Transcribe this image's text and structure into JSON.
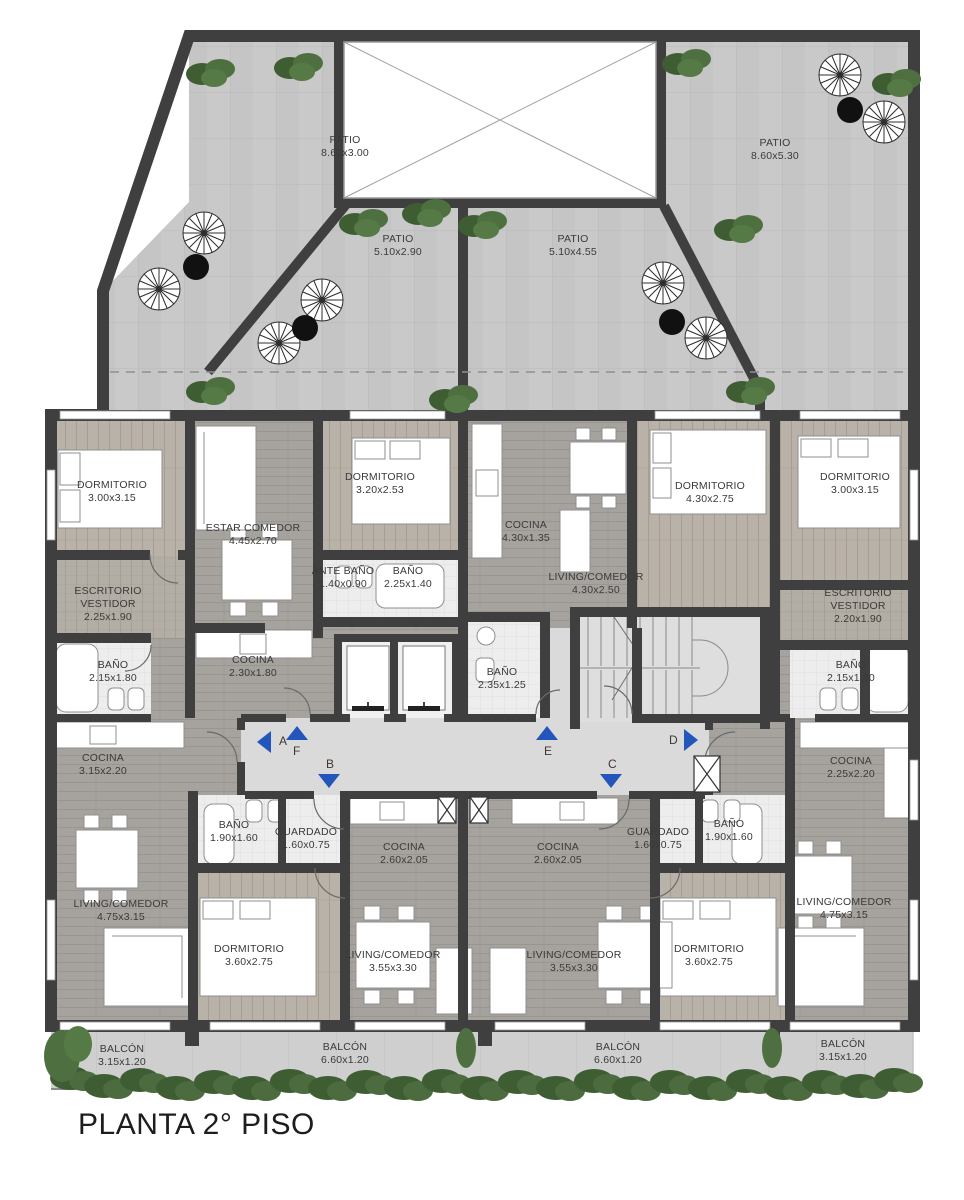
{
  "title": "PLANTA 2° PISO",
  "patios": {
    "nw": {
      "name": "PATIO",
      "dims": "8.60x3.00"
    },
    "cw": {
      "name": "PATIO",
      "dims": "5.10x2.90"
    },
    "ce": {
      "name": "PATIO",
      "dims": "5.10x4.55"
    },
    "ne": {
      "name": "PATIO",
      "dims": "8.60x5.30"
    }
  },
  "rooms": {
    "dorm_nw": {
      "name": "DORMITORIO",
      "dims": "3.00x3.15"
    },
    "escritorio_w": {
      "name": "ESCRITORIO",
      "name2": "VESTIDOR",
      "dims": "2.25x1.90"
    },
    "bano_w": {
      "name": "BAÑO",
      "dims": "2.15x1.80"
    },
    "estar": {
      "name": "ESTAR COMEDOR",
      "dims": "4.45x2.70"
    },
    "cocina_f": {
      "name": "COCINA",
      "dims": "2.30x1.80"
    },
    "dorm_c": {
      "name": "DORMITORIO",
      "dims": "3.20x2.53"
    },
    "ante_bano": {
      "name": "ANTE BAÑO",
      "dims": "1.40x0.90"
    },
    "bano_c": {
      "name": "BAÑO",
      "dims": "2.25x1.40"
    },
    "cocina_e": {
      "name": "COCINA",
      "dims": "4.30x1.35"
    },
    "living_e": {
      "name": "LIVING/COMEDOR",
      "dims": "4.30x2.50"
    },
    "bano_e": {
      "name": "BAÑO",
      "dims": "2.35x1.25"
    },
    "dorm_e": {
      "name": "DORMITORIO",
      "dims": "4.30x2.75"
    },
    "dorm_ne": {
      "name": "DORMITORIO",
      "dims": "3.00x3.15"
    },
    "escritorio_e": {
      "name": "ESCRITORIO",
      "name2": "VESTIDOR",
      "dims": "2.20x1.90"
    },
    "bano_r": {
      "name": "BAÑO",
      "dims": "2.15x1.80"
    },
    "cocina_a": {
      "name": "COCINA",
      "dims": "3.15x2.20"
    },
    "living_a": {
      "name": "LIVING/COMEDOR",
      "dims": "4.75x3.15"
    },
    "bano_a": {
      "name": "BAÑO",
      "dims": "1.90x1.60"
    },
    "guardado_a": {
      "name": "GUARDADO",
      "dims": "1.60x0.75"
    },
    "dorm_a": {
      "name": "DORMITORIO",
      "dims": "3.60x2.75"
    },
    "cocina_b": {
      "name": "COCINA",
      "dims": "2.60x2.05"
    },
    "living_b": {
      "name": "LIVING/COMEDOR",
      "dims": "3.55x3.30"
    },
    "cocina_c": {
      "name": "COCINA",
      "dims": "2.60x2.05"
    },
    "living_c": {
      "name": "LIVING/COMEDOR",
      "dims": "3.55x3.30"
    },
    "guardado_d": {
      "name": "GUARDADO",
      "dims": "1.60x0.75"
    },
    "bano_d": {
      "name": "BAÑO",
      "dims": "1.90x1.60"
    },
    "dorm_d": {
      "name": "DORMITORIO",
      "dims": "3.60x2.75"
    },
    "cocina_d2": {
      "name": "COCINA",
      "dims": "2.25x2.20"
    },
    "living_d": {
      "name": "LIVING/COMEDOR",
      "dims": "4.75x3.15"
    }
  },
  "balconies": {
    "b1": {
      "name": "BALCÓN",
      "dims": "3.15x1.20"
    },
    "b2": {
      "name": "BALCÓN",
      "dims": "6.60x1.20"
    },
    "b3": {
      "name": "BALCÓN",
      "dims": "6.60x1.20"
    },
    "b4": {
      "name": "BALCÓN",
      "dims": "3.15x1.20"
    }
  },
  "circulation": {
    "units": {
      "a": "A",
      "f": "F",
      "b": "B",
      "e": "E",
      "c": "C",
      "d": "D"
    }
  },
  "colors": {
    "wall": "#3f3f3f",
    "arrow_blue": "#2356bb",
    "letter": "#43362e",
    "patio_tile": "#c8c8c8",
    "corridor": "#dadada",
    "wood_gray": "#a6a39f",
    "wood_beige": "#b8b1a8",
    "bath": "#ededed",
    "hedge_green": "#44603a",
    "plant_green": "#4e7040",
    "label_text": "#3a3a3a",
    "title_text": "#1d1d1d"
  }
}
